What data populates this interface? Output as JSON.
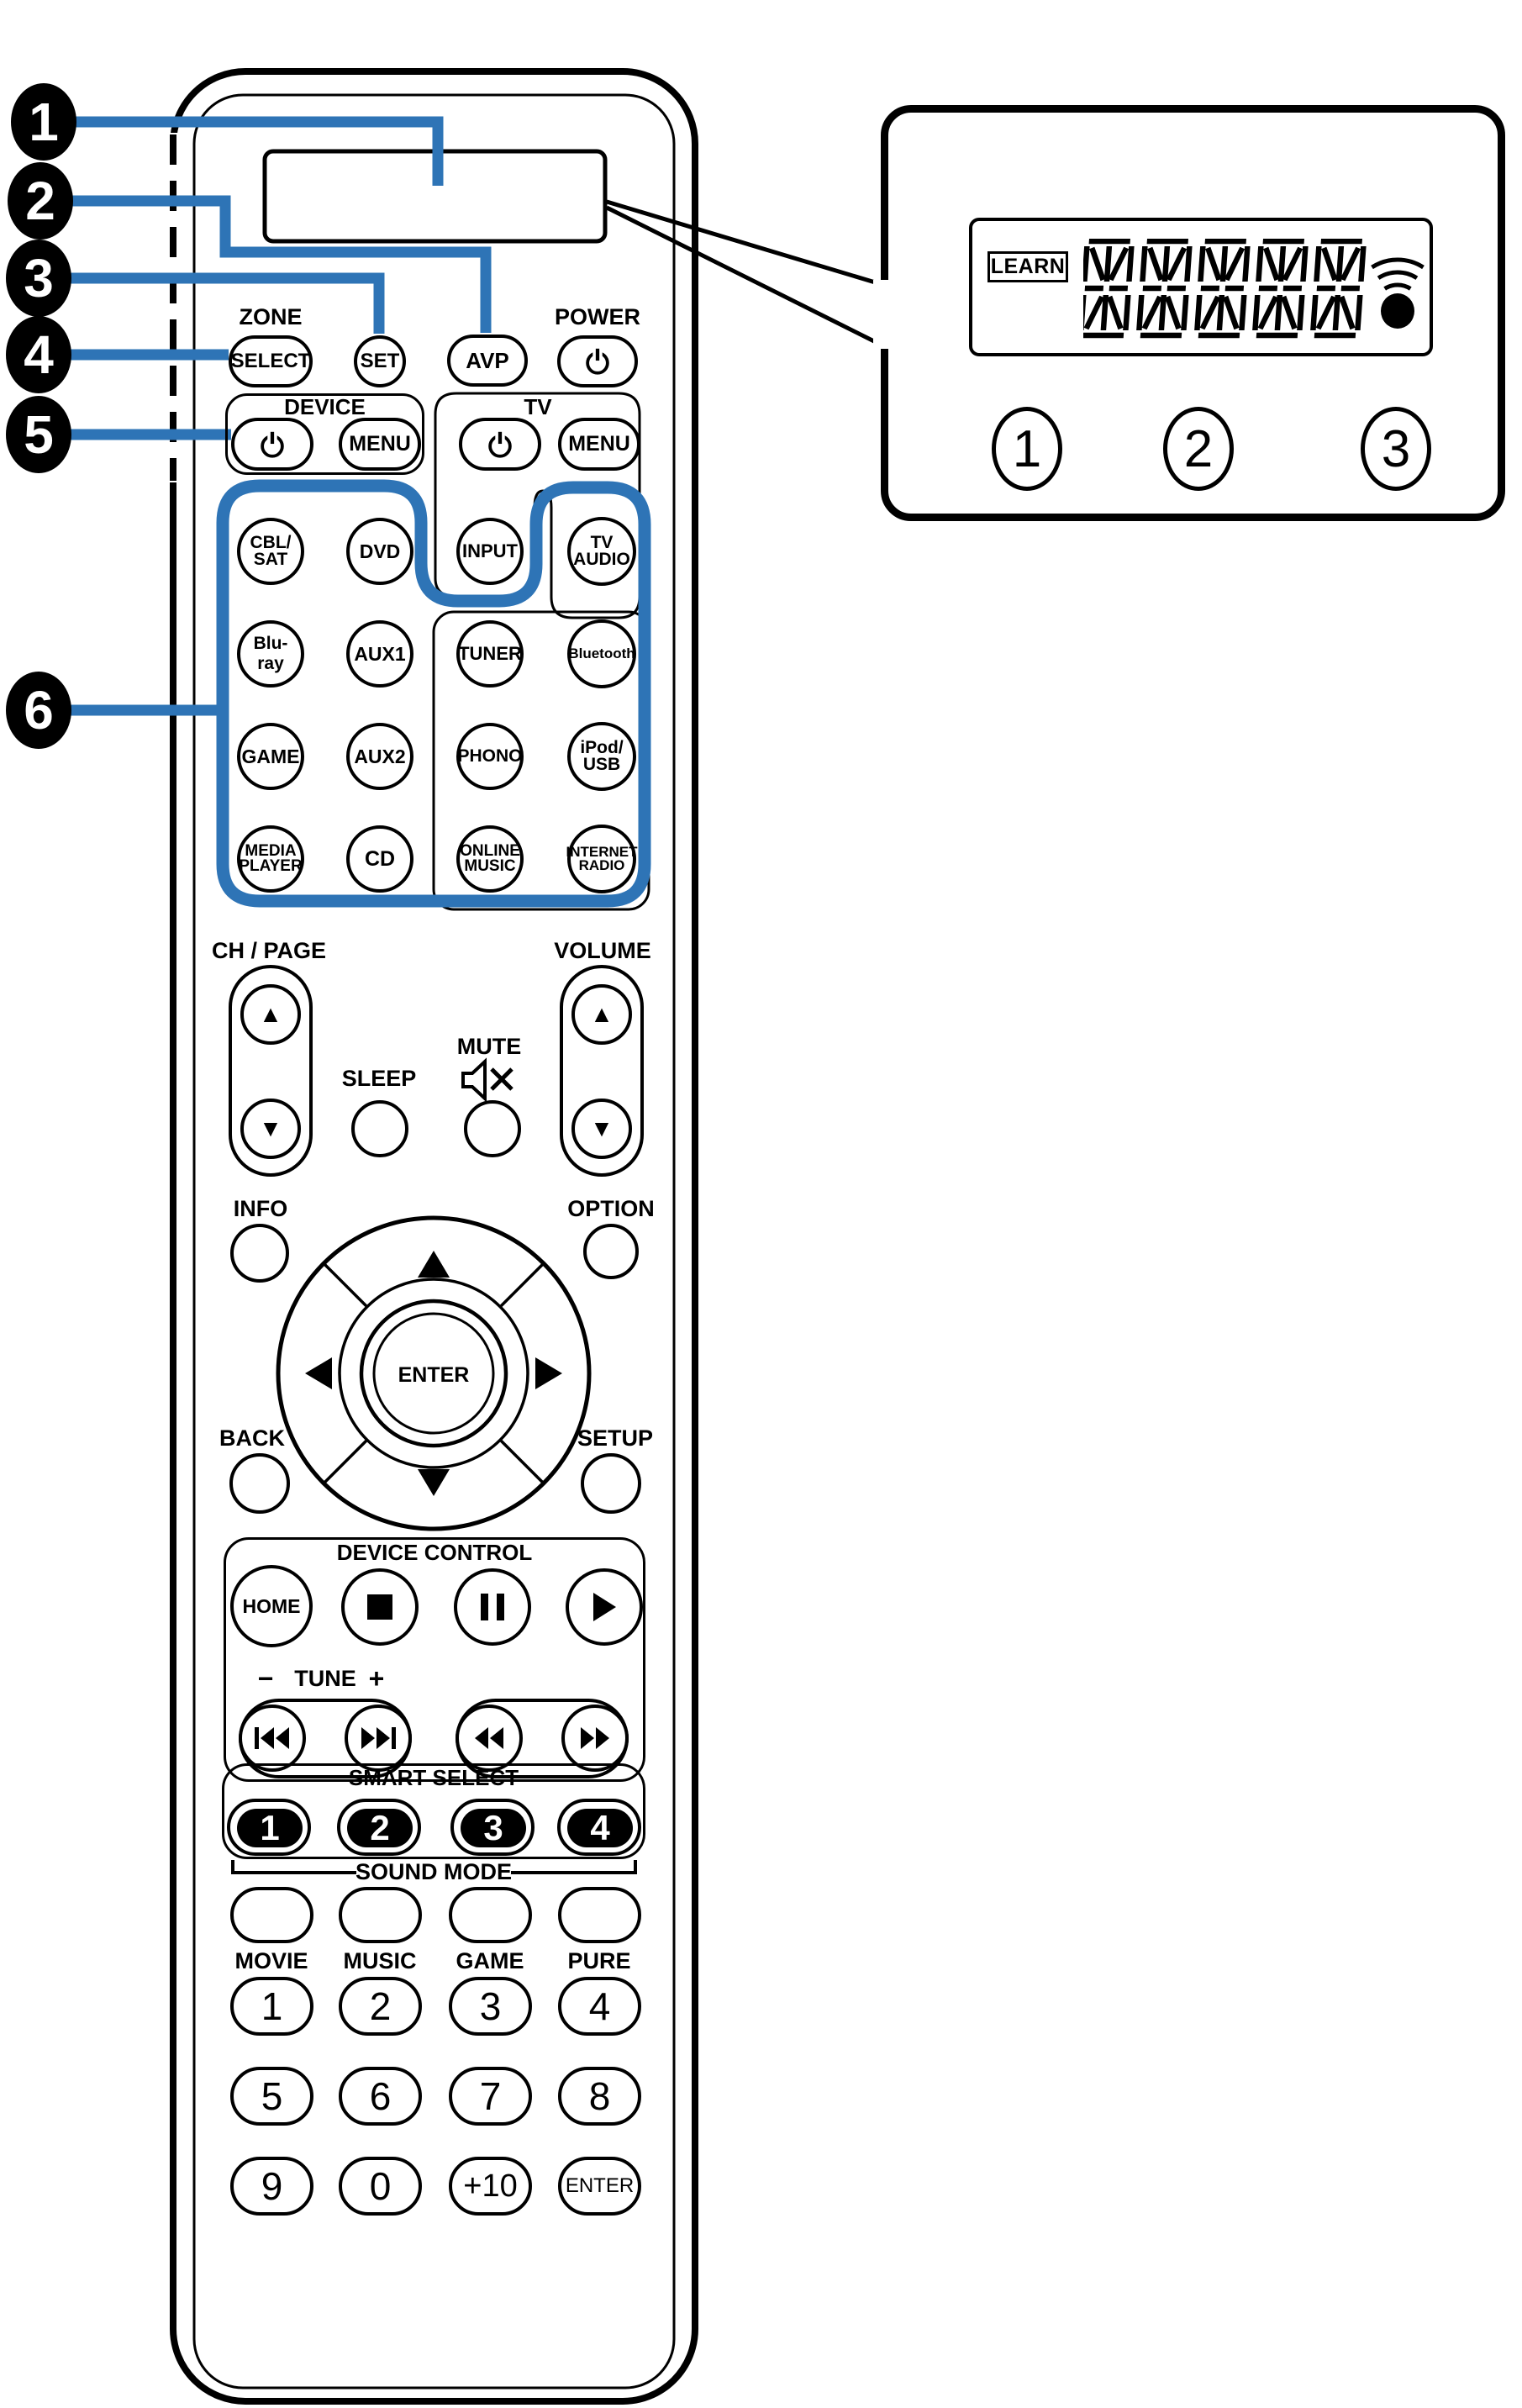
{
  "colors": {
    "accent_blue": "#2E74B6",
    "line_black": "#000000"
  },
  "badges": [
    "1",
    "2",
    "3",
    "4",
    "5",
    "6"
  ],
  "inset": {
    "learn_label": "LEARN",
    "segment_char_count": "5",
    "badges": [
      "1",
      "2",
      "3"
    ]
  },
  "top": {
    "zone_label": "ZONE",
    "select": "SELECT",
    "set": "SET",
    "avp": "AVP",
    "power_label": "POWER"
  },
  "device_group": {
    "label": "DEVICE",
    "menu": "MENU"
  },
  "tv_group": {
    "label": "TV",
    "menu": "MENU"
  },
  "source_buttons": [
    "CBL/\nSAT",
    "DVD",
    "INPUT",
    "TV\nAUDIO",
    "Blu-ray",
    "AUX1",
    "TUNER",
    "Bluetooth",
    "GAME",
    "AUX2",
    "PHONO",
    "iPod/\nUSB",
    "MEDIA\nPLAYER",
    "CD",
    "ONLINE\nMUSIC",
    "INTERNET\nRADIO"
  ],
  "mid": {
    "ch_page_label": "CH / PAGE",
    "volume_label": "VOLUME",
    "sleep_label": "SLEEP",
    "mute_label": "MUTE",
    "info_label": "INFO",
    "option_label": "OPTION",
    "enter_label": "ENTER",
    "back_label": "BACK",
    "setup_label": "SETUP"
  },
  "glyphs": {
    "up": "▲",
    "down": "▼"
  },
  "device_control": {
    "label": "DEVICE CONTROL",
    "home": "HOME",
    "tune_minus": "−",
    "tune_label": "TUNE",
    "tune_plus": "+"
  },
  "smart_select": {
    "label": "SMART SELECT",
    "numbers": [
      "1",
      "2",
      "3",
      "4"
    ]
  },
  "sound_mode": {
    "label": "SOUND MODE",
    "modes": [
      "MOVIE",
      "MUSIC",
      "GAME",
      "PURE"
    ]
  },
  "numpad": {
    "keys": [
      "1",
      "2",
      "3",
      "4",
      "5",
      "6",
      "7",
      "8",
      "9",
      "0",
      "+10"
    ],
    "enter": "ENTER"
  }
}
